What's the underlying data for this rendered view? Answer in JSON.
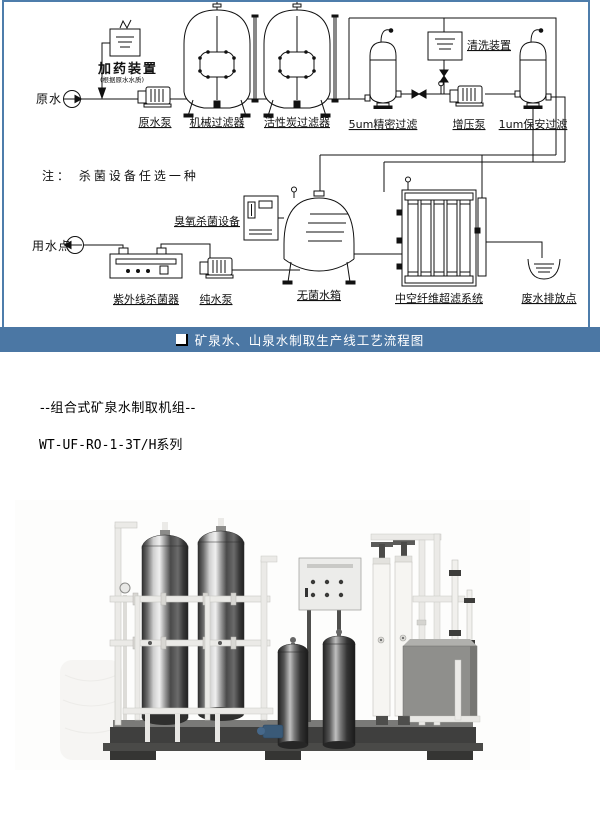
{
  "caption_bar": {
    "icon": "white-square-bullet",
    "text": "矿泉水、山泉水制取生产线工艺流程图",
    "bg_color": "#4b77a4"
  },
  "frame": {
    "border_color": "#4e7dab"
  },
  "intro": {
    "line1": "--组合式矿泉水制取机组--",
    "line2": "WT-UF-RO-1-3T/H系列"
  },
  "diagram": {
    "note": "注： 杀菌设备任选一种",
    "labels": {
      "raw_water": "原水",
      "dosing_device": "加药装置",
      "dosing_note": "(根据原水水质)",
      "raw_water_pump": "原水泵",
      "mechanical_filter": "机械过滤器",
      "carbon_filter": "活性炭过滤器",
      "filter_5um": "5um精密过滤",
      "booster_pump": "增压泵",
      "filter_1um": "1um保安过滤",
      "cleaning_device": "清洗装置",
      "ozone_device": "臭氧杀菌设备",
      "water_use_point": "用水点",
      "uv_sterilizer": "紫外线杀菌器",
      "pure_water_pump": "纯水泵",
      "sterile_tank": "无菌水箱",
      "uf_system": "中空纤维超滤系统",
      "waste_drain": "废水排放点"
    },
    "line_color": "#111111"
  }
}
